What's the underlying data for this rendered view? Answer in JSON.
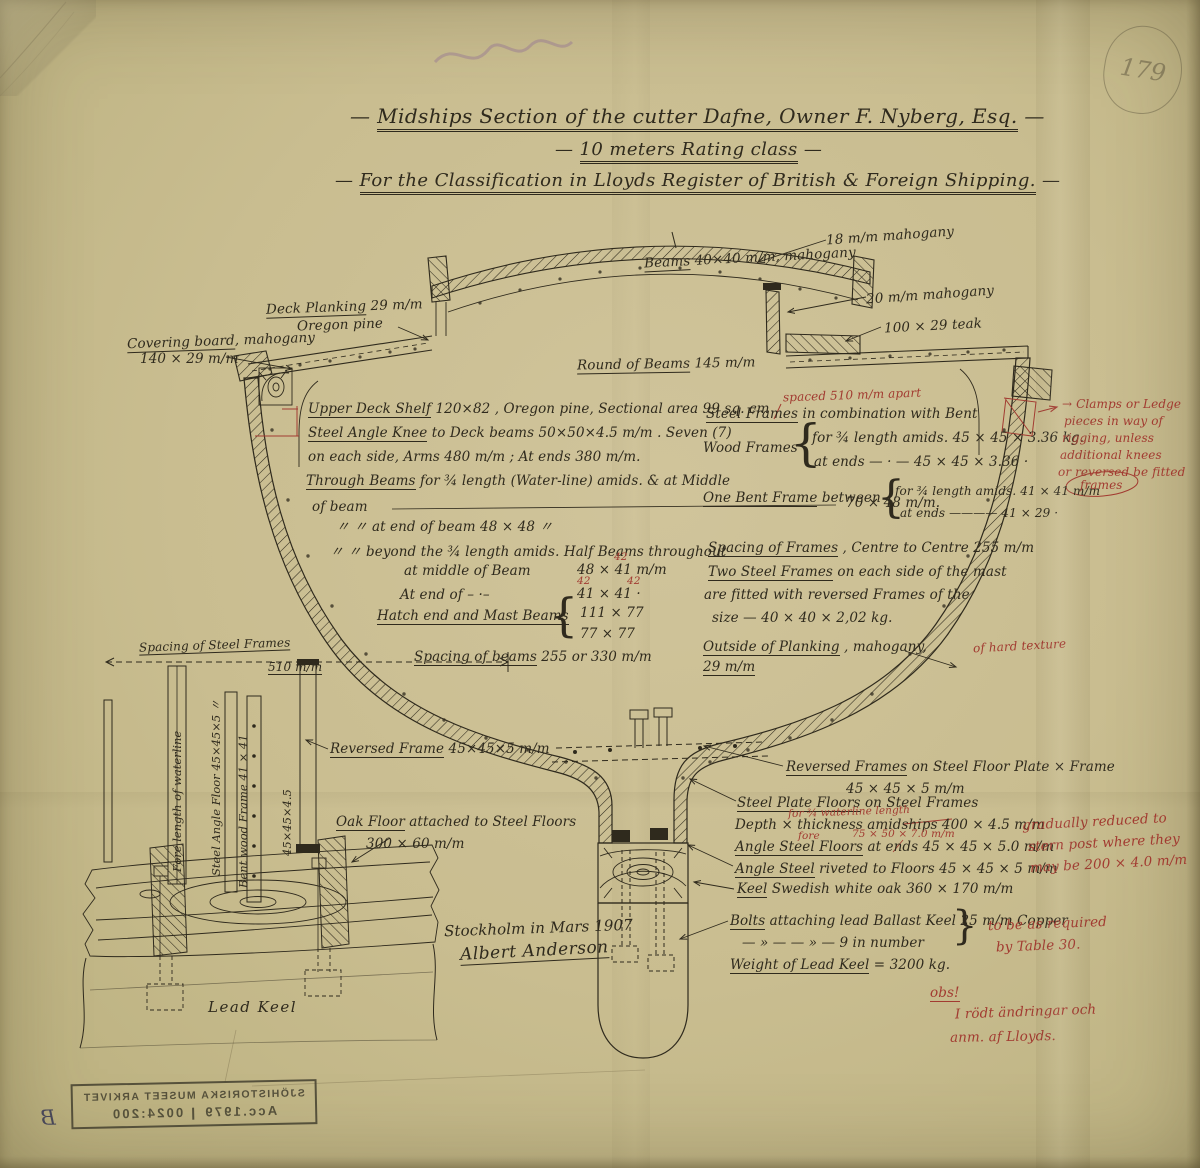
{
  "title": {
    "dash": "—",
    "line1": "Midships Section of the cutter Dafne, Owner F. Nyberg, Esq.",
    "line2": "10 meters Rating class",
    "line3": "For the Classification in Lloyds Register of British & Foreign Shipping."
  },
  "glyphs": {
    "brl": "{",
    "brr": "}"
  },
  "labels": {
    "dp1": {
      "hd": "Deck Planking",
      "tx": " 29 m/m"
    },
    "dp2": {
      "tx": "Oregon pine"
    },
    "cb1": {
      "hd": "Covering board",
      "tx": ", mahogany"
    },
    "cb2": {
      "tx": "140 × 29 m/m"
    },
    "mah18": {
      "tx": "18 m/m mahogany"
    },
    "beams": {
      "hd": "Beams",
      "tx": " 40×40 m/m, mahogany"
    },
    "mah20": {
      "tx": "20 m/m mahogany"
    },
    "teak": {
      "tx": "100 × 29 teak"
    },
    "rob": {
      "hd": "Round of Beams",
      "tx": " 145 m/m"
    },
    "uds": {
      "hd": "Upper Deck Shelf",
      "tx": " 120×82 , Oregon pine, Sectional area 99 sq. cm"
    },
    "sak": {
      "hd": "Steel Angle Knee",
      "tx": " to Deck beams    50×50×4.5 m/m . Seven (7)"
    },
    "sak2": {
      "tx": "on each side, Arms 480 m/m ; At ends 380 m/m."
    },
    "tb": {
      "hd": "Through Beams",
      "tx": " for ¾ length (Water-line) amids. & at Middle"
    },
    "tb2": {
      "tx": "of beam"
    },
    "tb2v": {
      "tx": "70 × 48 m/m."
    },
    "tb3": {
      "tx": "〃            〃                at end of beam      48 × 48   〃"
    },
    "tb4": {
      "tx": "〃       〃   beyond the ¾ length amids.  Half Beams throughout"
    },
    "tb5": {
      "tx": "at middle of Beam"
    },
    "tb5v": {
      "tx": "48 × 41 m/m"
    },
    "tb6": {
      "tx": "At end of    – ·–"
    },
    "tb6v": {
      "tx": "41 × 41   ·"
    },
    "r42a": {
      "tx": "42"
    },
    "r42b": {
      "tx": "42"
    },
    "r42c": {
      "tx": "42"
    },
    "hm": {
      "hd": "Hatch end and Mast Beams"
    },
    "hmv1": {
      "tx": "111 ×   77"
    },
    "hmv2": {
      "tx": "77 ×   77"
    },
    "sb": {
      "hd": "Spacing of beams",
      "tx": "  255  or 330 m/m"
    },
    "rspaced": {
      "tx": "spaced 510 m/m apart"
    },
    "sf": {
      "hd": "Steel Frames",
      "tx": " in combination with Bent"
    },
    "wf": {
      "tx": "Wood Frames"
    },
    "wf1": {
      "tx": "for ¾ length amids.    45 × 45 × 3.36 kg."
    },
    "wf2": {
      "tx": "at ends   — · —        45 × 45 × 3.36  ·"
    },
    "obf": {
      "hd": "One Bent Frame",
      "tx": " between"
    },
    "obf1": {
      "tx": "for ¾ length amids.   41 × 41 m/m"
    },
    "obf2": {
      "tx": "at ends   ————   41 × 29   ·"
    },
    "spf": {
      "hd": "Spacing of Frames",
      "tx": " , Centre to Centre        255 m/m"
    },
    "ts1": {
      "hd": "Two Steel Frames",
      "tx": " on each side of the mast"
    },
    "ts2": {
      "tx": "are fitted with reversed Frames of the"
    },
    "ts3": {
      "tx": "size   —    40 × 40 × 2,02 kg."
    },
    "op1": {
      "hd": "Outside of Planking",
      "tx": " , mahogany,"
    },
    "op2": {
      "hd": "29 m/m"
    },
    "rhard": {
      "tx": "of hard texture"
    },
    "rcl1": {
      "tx": "→ Clamps or Ledge"
    },
    "rcl2": {
      "tx": "pieces in way of"
    },
    "rcl3": {
      "tx": "rigging, unless"
    },
    "rcl4": {
      "tx": "additional knees"
    },
    "rcl5": {
      "tx": "or reversed be fitted"
    },
    "rcl6": {
      "tx": "frames"
    },
    "ssf": {
      "hd": "Spacing of Steel Frames"
    },
    "ssfv": {
      "tx": "510 m/m"
    },
    "rfore": {
      "tx": "Fore length of waterline"
    },
    "saf": {
      "tx": "Steel Angle Floor 45×45×5 〃"
    },
    "bwf": {
      "tx": "Bent wood Frame 41 × 41"
    },
    "v45": {
      "tx": "45×45×4.5"
    },
    "rf": {
      "hd": "Reversed Frame",
      "tx": " 45×45×5 m/m"
    },
    "oak": {
      "hd": "Oak Floor",
      "tx": " attached to Steel Floors"
    },
    "oak2": {
      "tx": "300 × 60 m/m"
    },
    "lk": {
      "tx": "Lead Keel"
    },
    "rff": {
      "hd": "Reversed Frames",
      "tx": " on Steel Floor Plate × Frame"
    },
    "rffv": {
      "tx": "45 × 45 × 5 m/m"
    },
    "spfl": {
      "hd": "Steel Plate Floors",
      "tx": " on Steel Frames"
    },
    "dt": {
      "tx": "Depth × thickness amidships  400 × 4.5 m/m"
    },
    "rfor34": {
      "tx": "for ¾ waterline length"
    },
    "asf": {
      "hd": "Angle Steel Floors",
      "tx": "   at ends    45 × 45 × 5.0 m/m"
    },
    "rforew": {
      "tx": "fore"
    },
    "r7550": {
      "tx": "75 × 50 × 7.0 m/m"
    },
    "asr": {
      "hd": "Angle Steel",
      "tx": " riveted to Floors     45 × 45 × 5 m/m"
    },
    "rgr1": {
      "tx": "gradually reduced to"
    },
    "rgr2": {
      "tx": "stern post where they"
    },
    "rgr3": {
      "tx": "may be 200 × 4.0 m/m"
    },
    "keel": {
      "hd": "Keel",
      "tx": " Swedish white oak   360 × 170 m/m"
    },
    "bolts": {
      "hd": "Bolts",
      "tx": " attaching lead Ballast Keel 25 m/m Copper"
    },
    "bolts2": {
      "tx": "—   »   —        — » —     9 in number"
    },
    "rt30a": {
      "tx": "to be as required"
    },
    "rt30b": {
      "tx": "by Table 30."
    },
    "wt": {
      "hd": "Weight of Lead Keel",
      "tx": " = 3200 kg."
    },
    "sth": {
      "tx": "Stockholm in Mars 1907"
    },
    "sig": {
      "tx": "Albert Anderson"
    },
    "robs": {
      "tx": "obs!"
    },
    "robs2": {
      "tx": "I rödt ändringar och"
    },
    "robs3": {
      "tx": "anm. af Lloyds."
    }
  },
  "stamp": {
    "l1": "SJÖHISTORISKA MUSEET ARKIVET",
    "acc": "Acc.1979",
    "num": "0024:200",
    "mark": "B"
  },
  "pencil": {
    "num": "179"
  }
}
